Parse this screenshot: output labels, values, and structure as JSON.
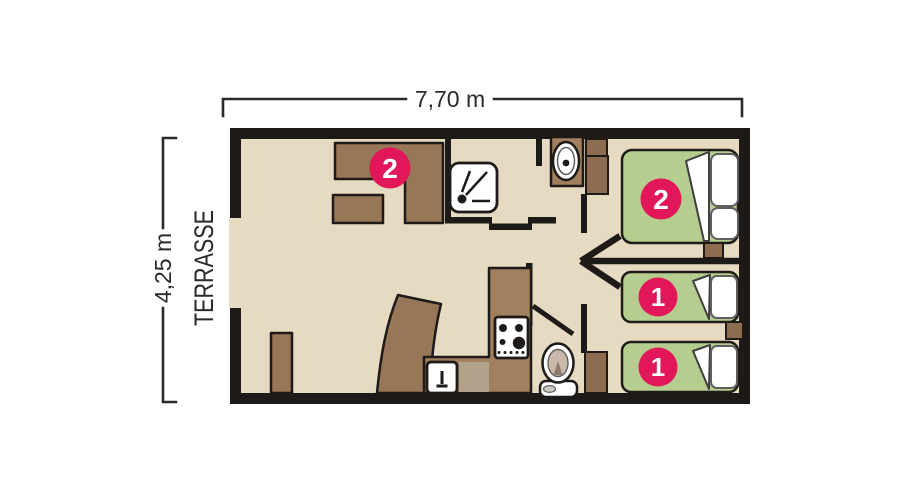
{
  "plan": {
    "width_label": "7,70 m",
    "height_label": "4,25 m",
    "terrace_label": "TERRASSE"
  },
  "badges": {
    "living_area": "2",
    "double_bed": "2",
    "single_bed_top": "1",
    "single_bed_bottom": "1"
  },
  "colors": {
    "wall": "#1d1a18",
    "floor": "#e6dac2",
    "furniture_brown": "#987658",
    "counter_brown": "#a2805f",
    "wardrobe_brown": "#8d6c4f",
    "appliance_taupe": "#b2a18b",
    "bed_green": "#b5cd8e",
    "badge_pink": "#e2175a",
    "label_dark": "#2b2a29"
  },
  "icons": {
    "shower": "shower-head-icon",
    "washbasin": "washbasin-icon",
    "toilet": "toilet-icon",
    "stove": "stove-burners-icon",
    "kitchen_sink": "kitchen-faucet-icon",
    "entrance_arrow": "entrance-arrow-icon"
  }
}
